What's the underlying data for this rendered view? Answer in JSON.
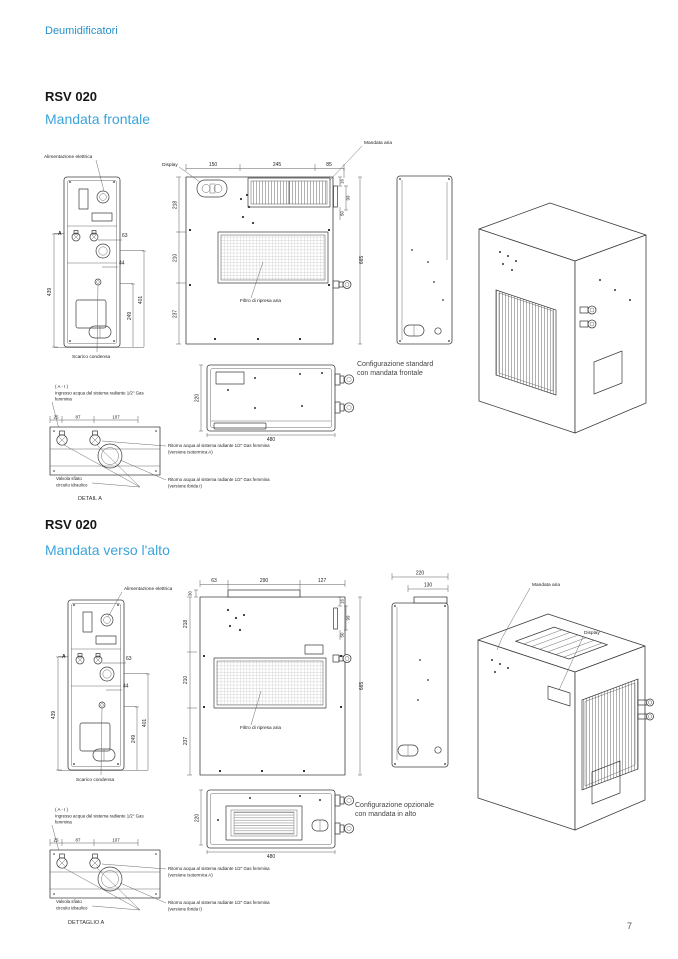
{
  "page": {
    "header": "Deumidificatori",
    "page_number": "7"
  },
  "colors": {
    "heading_blue": "#2B90C8",
    "subtitle_blue": "#3BA4DA",
    "line_dark": "#3C3C3C"
  },
  "sections": [
    {
      "title": "RSV 020",
      "subtitle": "Mandata frontale",
      "config": [
        "Configurazione standard",
        "con mandata frontale"
      ],
      "detail_title": "DETAIL A",
      "labels": {
        "alimentazione": "Alimentazione elettrica",
        "display": "Display",
        "mandata_aria": "Mandata aria",
        "filtro": "Filtro di ripresa aria",
        "scarico": "Scarico condensa",
        "marker_a": "A",
        "detail_ref": "( A - I )",
        "ingresso": [
          "Ingresso acqua dal sistema radiante 1/2\" Gas",
          "femmina"
        ],
        "valvola": [
          "Valvola sfiato",
          "circuito idraulico"
        ],
        "ritorno_isotermica": [
          "Ritorno acqua al sistema radiante 1/2\" Gas femmina",
          "(versione isotermica A)"
        ],
        "ritorno_ibrida": [
          "Ritorno acqua al sistema radiante 1/2\" Gas femmina",
          "(versione ibrida I)"
        ]
      },
      "dims": {
        "back_height": "439",
        "back_63": "63",
        "back_44": "44",
        "back_249": "249",
        "back_401": "401",
        "front_top": [
          "150",
          "245",
          "85"
        ],
        "front_left": [
          "218",
          "210",
          "237"
        ],
        "front_right": [
          "16",
          "99",
          "50"
        ],
        "front_height": "665",
        "plan_depth": "220",
        "plan_width": "480",
        "detail": [
          "25",
          "87",
          "107"
        ]
      }
    },
    {
      "title": "RSV 020",
      "subtitle": "Mandata verso l'alto",
      "config": [
        "Configurazione opzionale",
        "con mandata in alto"
      ],
      "detail_title": "DETTAGLIO A",
      "labels": {
        "alimentazione": "Alimentazione elettrica",
        "display": "Display",
        "mandata_aria": "Mandata aria",
        "filtro": "Filtro di ripresa aria",
        "scarico": "Scarico condensa",
        "marker_a": "A",
        "detail_ref": "( A - I )",
        "ingresso": [
          "Ingresso acqua dal sistema radiante 1/2\" Gas",
          "femmina"
        ],
        "valvola": [
          "Valvola sfiato",
          "circuito idraulico"
        ],
        "ritorno_isotermica": [
          "Ritorno acqua al sistema radiante 1/2\" Gas femmina",
          "(versione isotermica A)"
        ],
        "ritorno_ibrida": [
          "Ritorno acqua al sistema radiante 1/2\" Gas femmina",
          "(versione ibrida I)"
        ]
      },
      "dims": {
        "back_height": "439",
        "back_63": "63",
        "back_44": "44",
        "back_249": "249",
        "back_401": "401",
        "front_top": [
          "63",
          "290",
          "127"
        ],
        "front_left": [
          "218",
          "210",
          "237"
        ],
        "front_right": [
          "16",
          "99",
          "50"
        ],
        "front_height": "665",
        "outlet_offset": "30",
        "side_top": [
          "220",
          "130"
        ],
        "plan_depth": "220",
        "plan_width": "480",
        "detail": [
          "25",
          "87",
          "107"
        ]
      }
    }
  ]
}
